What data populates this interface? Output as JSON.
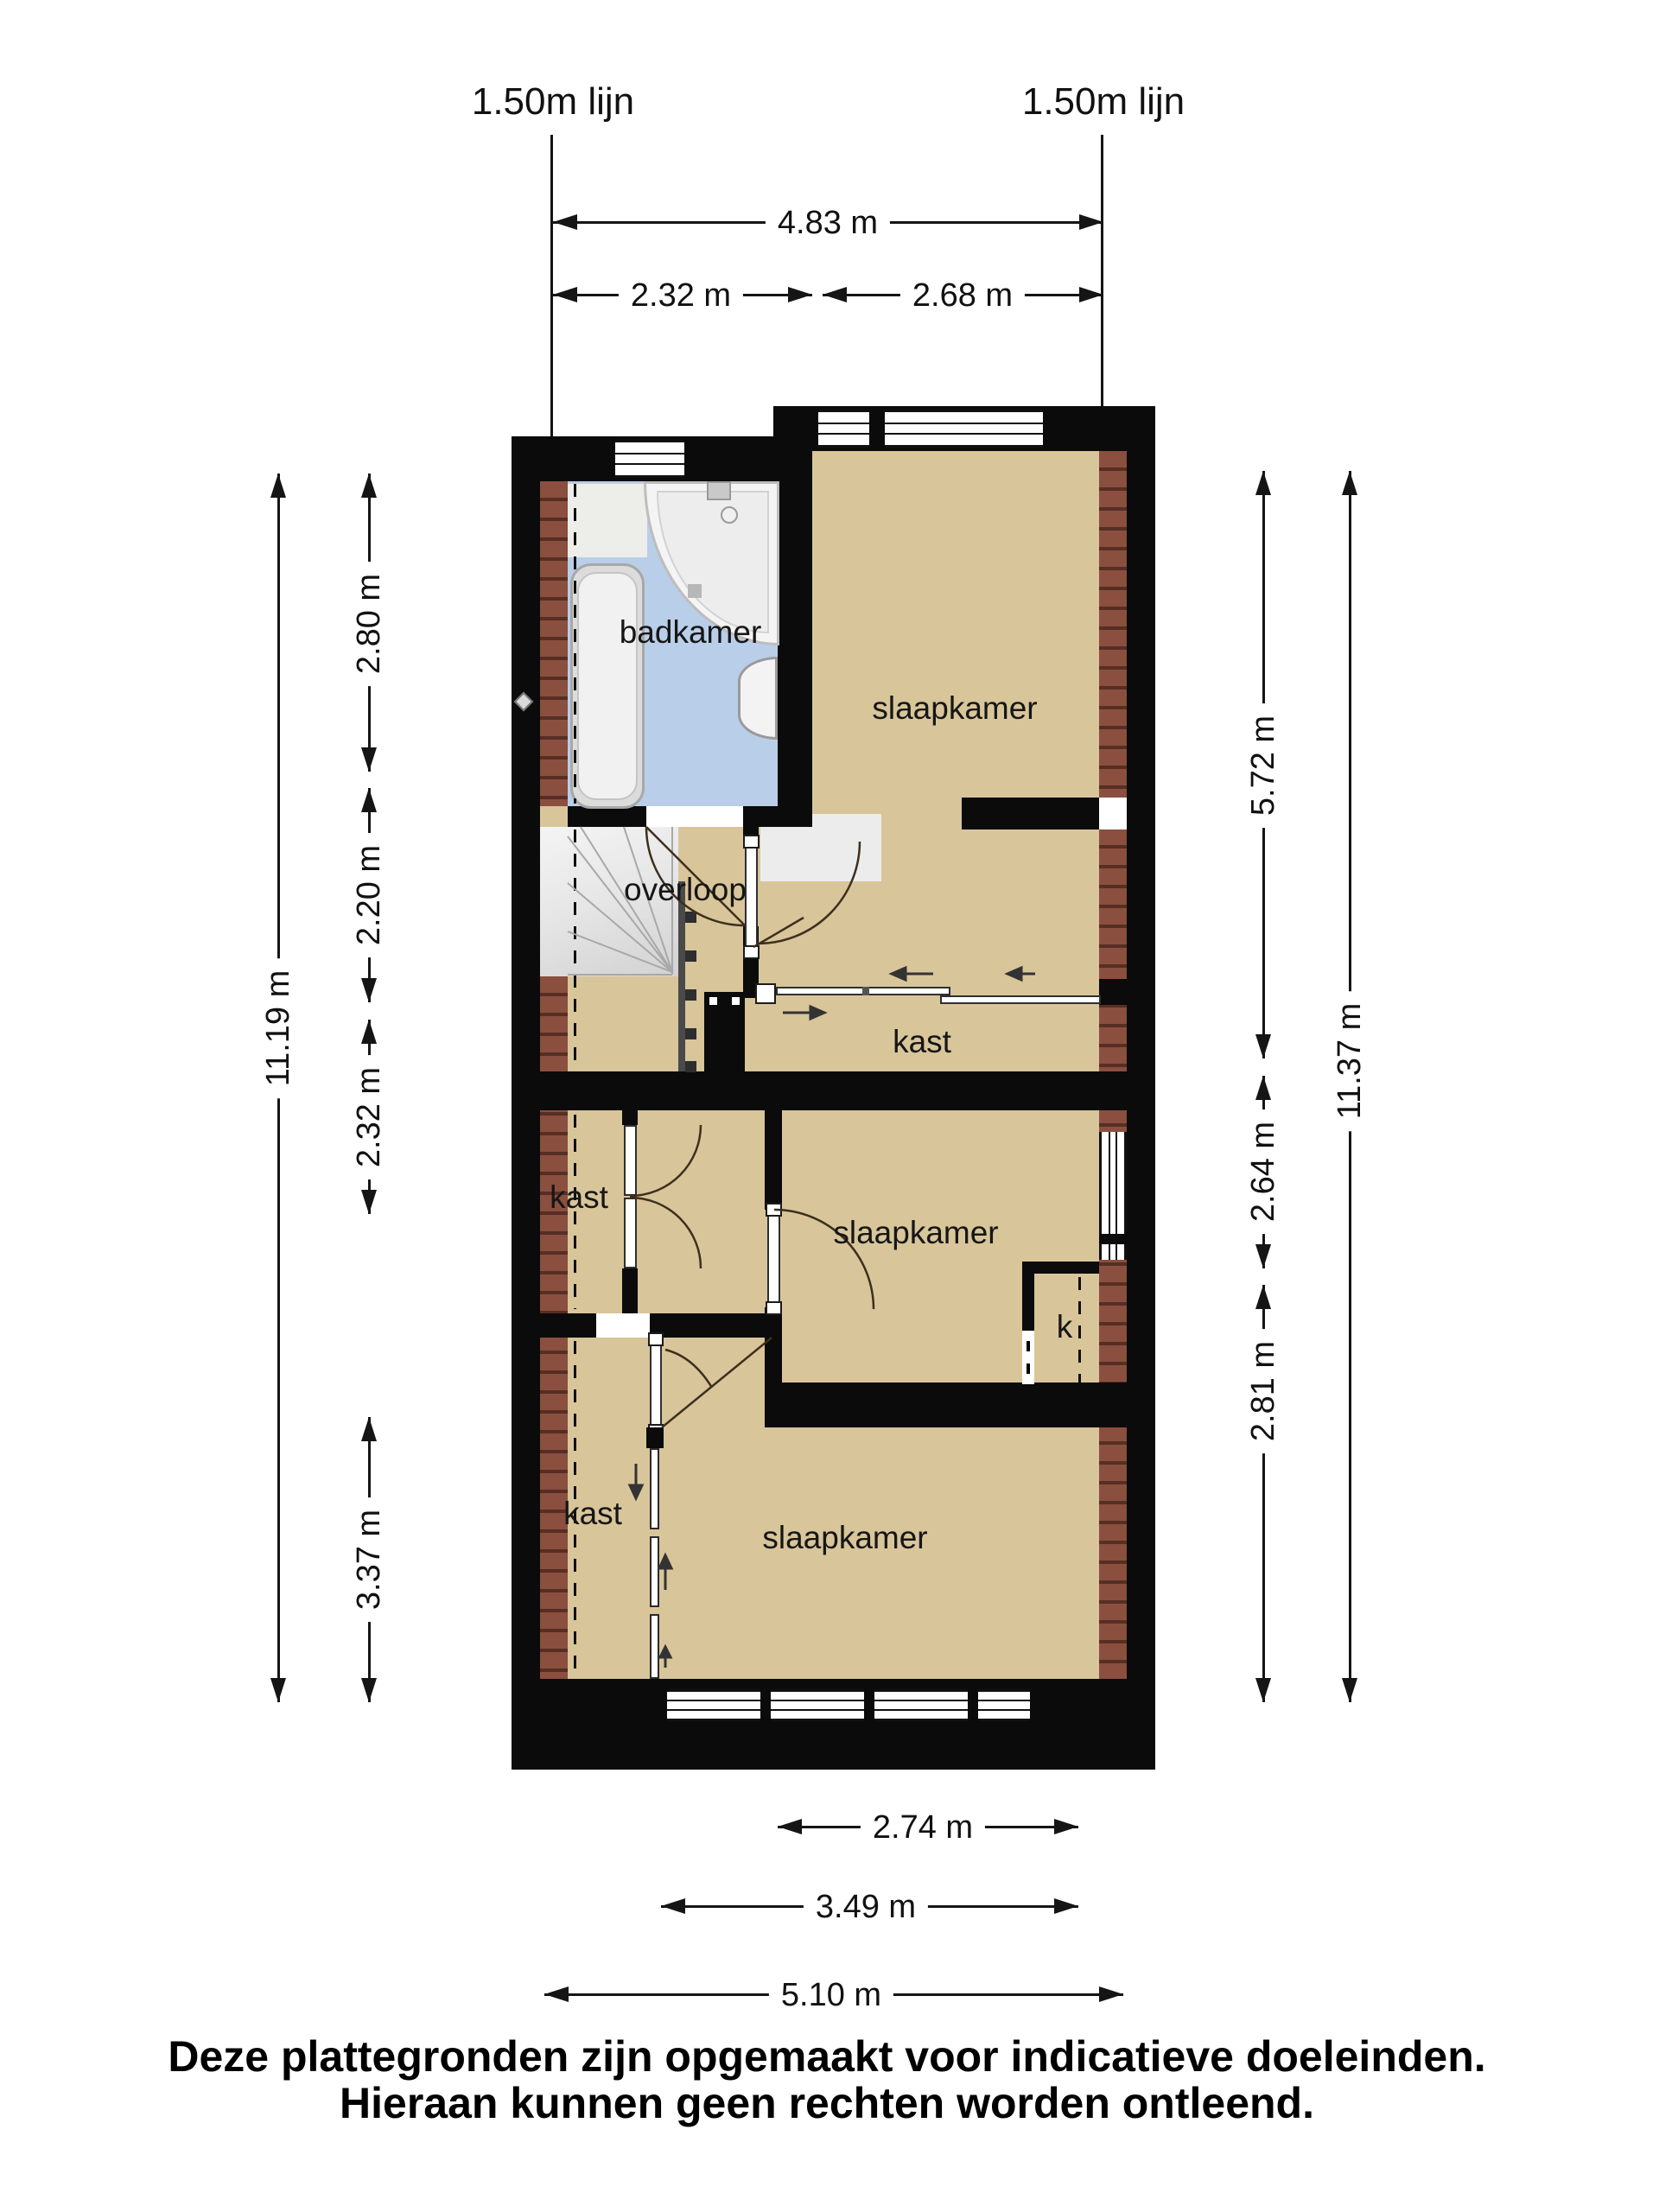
{
  "annotations": {
    "left_line": "1.50m lijn",
    "right_line": "1.50m lijn"
  },
  "dimensions": {
    "top_overall": "4.83 m",
    "top_left": "2.32 m",
    "top_right": "2.68 m",
    "left_outer": "11.19 m",
    "left_1": "2.80 m",
    "left_2": "2.20 m",
    "left_3": "2.32 m",
    "left_4": "3.37 m",
    "right_outer": "11.37 m",
    "right_1": "5.72 m",
    "right_2": "2.64 m",
    "right_3": "2.81 m",
    "bottom_1": "2.74 m",
    "bottom_2": "3.49 m",
    "bottom_3": "5.10 m"
  },
  "rooms": {
    "bathroom": "badkamer",
    "bedroom_top": "slaapkamer",
    "landing": "overloop",
    "closet_mid": "kast",
    "closet_left": "kast",
    "bedroom_mid": "slaapkamer",
    "closet_small": "k",
    "closet_bottom": "kast",
    "bedroom_bottom": "slaapkamer"
  },
  "footer": {
    "line1": "Deze plattegronden zijn opgemaakt voor indicatieve doeleinden.",
    "line2": "Hieraan kunnen geen rechten worden ontleend."
  },
  "colors": {
    "floor": "#d8c59a",
    "bathroom_floor": "#b9cee8",
    "wall": "#0b0b0b",
    "brick": "#8a4f3f",
    "brick_dark": "#572e24",
    "stairs": "#e8e8e8"
  }
}
